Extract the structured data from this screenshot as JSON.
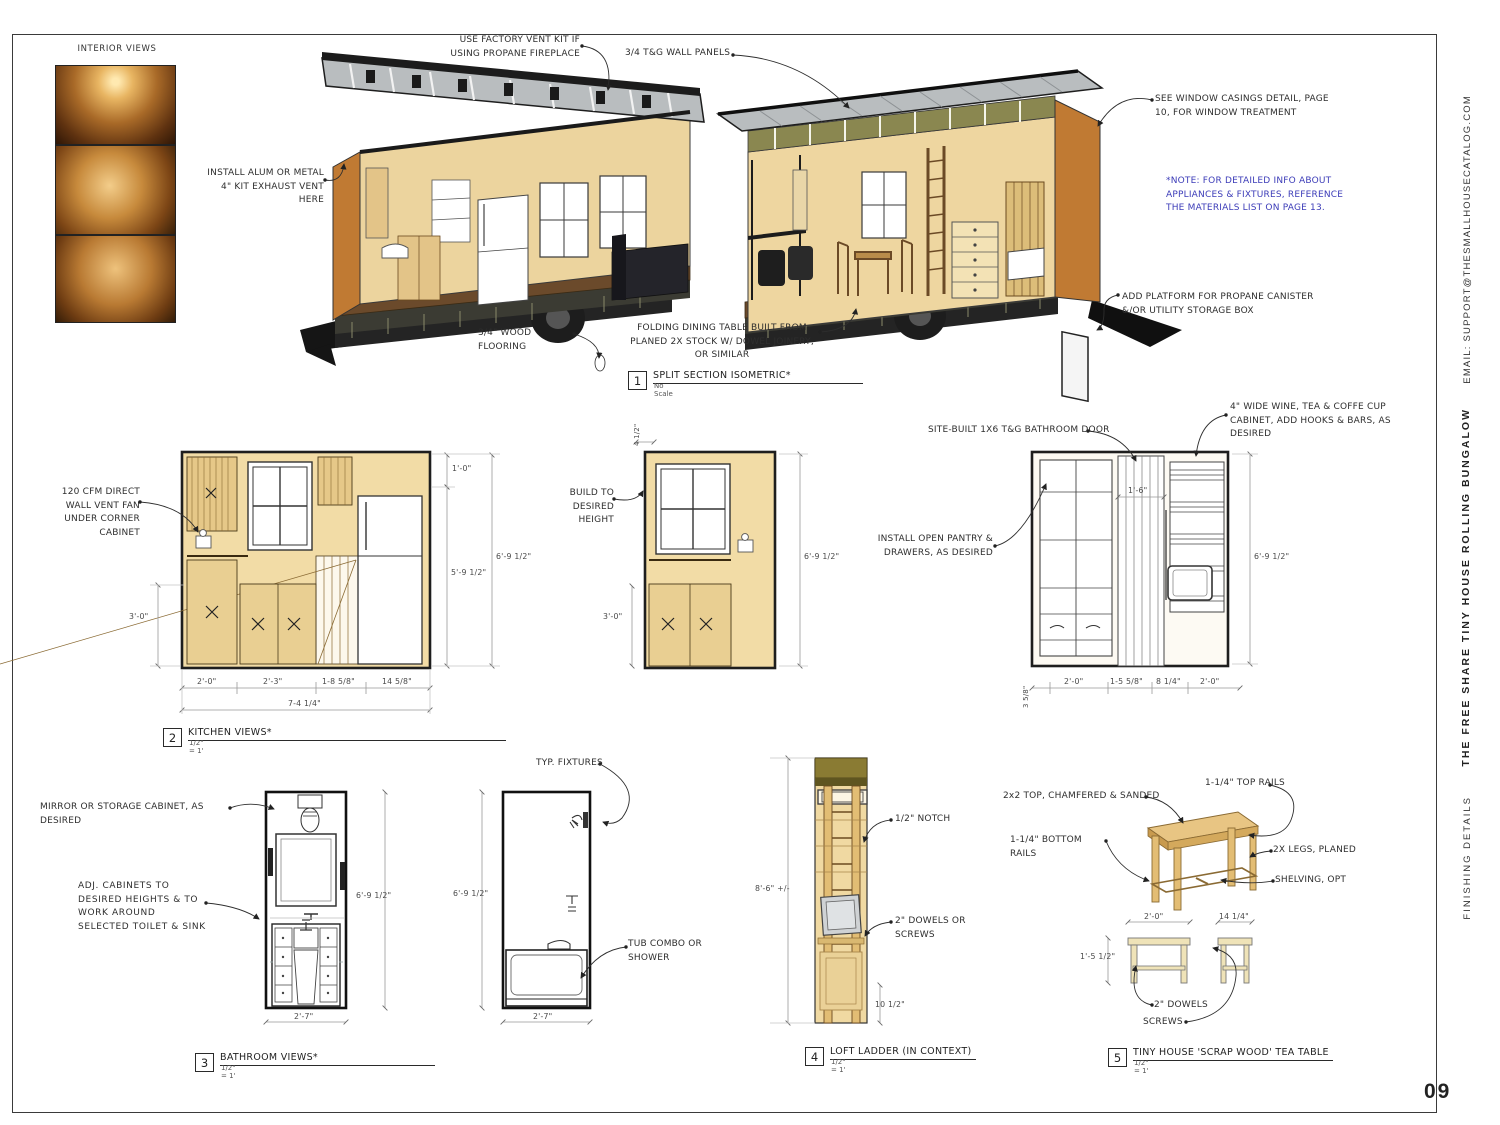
{
  "sheet": {
    "page_number": "09",
    "email_vertical": "EMAIL: SUPPORT@THESMALLHOUSECATALOG.COM",
    "title_vertical": "THE FREE SHARE TINY HOUSE ROLLING BUNGALOW",
    "section_vertical": "FINISHING DETAILS"
  },
  "colors": {
    "paper": "#ffffff",
    "line": "#2b2b2b",
    "wall_tan": "#f2dca6",
    "end_wall_orange": "#c07a33",
    "roof_gray": "#b9bdbf",
    "sheathing_olive": "#8a8750",
    "note_blue": "#3c3cb8",
    "dim_gray": "#999999"
  },
  "interior_views": {
    "label": "INTERIOR VIEWS"
  },
  "iso_notes": {
    "vent_kit": "USE FACTORY VENT KIT IF USING PROPANE FIREPLACE",
    "wall_panels": "3/4 T&G WALL PANELS",
    "exhaust_vent": "INSTALL ALUM OR METAL 4\" KIT EXHAUST VENT HERE",
    "window_casings": "SEE WINDOW CASINGS DETAIL, PAGE 10, FOR WINDOW TREATMENT",
    "materials_note": "*NOTE: FOR DETAILED INFO ABOUT APPLIANCES & FIXTURES, REFERENCE THE MATERIALS LIST ON PAGE 13.",
    "platform": "ADD PLATFORM FOR PROPANE CANISTER &/OR UTILITY STORAGE BOX",
    "flooring": "3/4\" WOOD FLOORING",
    "dining_table": "FOLDING DINING TABLE BUILT FROM PLANED 2X STOCK W/ DOWEL JOINERY, OR SIMILAR"
  },
  "callouts": {
    "c1": {
      "num": "1",
      "title": "SPLIT SECTION ISOMETRIC*",
      "scale": "No Scale"
    },
    "c2": {
      "num": "2",
      "title": "KITCHEN VIEWS*",
      "scale": "1/2\" = 1'"
    },
    "c3": {
      "num": "3",
      "title": "BATHROOM VIEWS*",
      "scale": "1/2\" = 1'"
    },
    "c4": {
      "num": "4",
      "title": "LOFT LADDER (IN CONTEXT)",
      "scale": "1/2\" = 1'"
    },
    "c5": {
      "num": "5",
      "title": "TINY HOUSE 'SCRAP WOOD' TEA TABLE",
      "scale": "1/2\" = 1'"
    }
  },
  "kitchen": {
    "notes": {
      "vent_fan": "120 CFM DIRECT WALL VENT FAN UNDER CORNER CABINET",
      "build_height": "BUILD TO DESIRED HEIGHT",
      "bathroom_door": "SITE-BUILT 1X6 T&G BATHROOM DOOR",
      "wine_cabinet": "4\" WIDE WINE, TEA & COFFE CUP CABINET, ADD HOOKS & BARS, AS DESIRED",
      "pantry": "INSTALL OPEN PANTRY & DRAWERS, AS DESIRED"
    },
    "dims": {
      "a_left": "3'-0\"",
      "a_right_top": "1'-0\"",
      "a_right_mid": "5'-9 1/2\"",
      "a_right_full": "6'-9 1/2\"",
      "a_b1": "2'-0\"",
      "a_b2": "2'-3\"",
      "a_b3": "1-8 5/8\"",
      "a_b4": "14 5/8\"",
      "a_total": "7-4 1/4\"",
      "b_top": "4 1/2\"",
      "b_left": "3'-0\"",
      "b_right": "6'-9 1/2\"",
      "c_inner": "1'-6\"",
      "c_right": "6'-9 1/2\"",
      "c_b0": "3 5/8\"",
      "c_b1": "2'-0\"",
      "c_b2": "1-5 5/8\"",
      "c_b3": "8 1/4\"",
      "c_b4": "2'-0\""
    }
  },
  "bathroom": {
    "notes": {
      "mirror": "MIRROR OR STORAGE CABINET, AS DESIRED",
      "adj_cabinets": "ADJ. CABINETS TO DESIRED HEIGHTS & TO WORK AROUND SELECTED TOILET & SINK",
      "fixtures": "TYP. FIXTURES",
      "tub": "TUB COMBO OR SHOWER"
    },
    "dims": {
      "a_height": "6'-9 1/2\"",
      "b_height": "6'-9 1/2\"",
      "a_width": "2'-7\"",
      "b_width": "2'-7\""
    }
  },
  "ladder": {
    "notes": {
      "notch": "1/2\" NOTCH",
      "dowels": "2\" DOWELS OR SCREWS"
    },
    "dims": {
      "height": "8'-6\" +/-",
      "offset": "10 1/2\""
    }
  },
  "table": {
    "notes": {
      "top": "2x2 TOP, CHAMFERED & SANDED",
      "top_rails": "1-1/4\" TOP RAILS",
      "bottom_rails": "1-1/4\" BOTTOM RAILS",
      "legs": "2X LEGS, PLANED",
      "shelving": "SHELVING, OPT",
      "dowels": "2\" DOWELS",
      "screws": "SCREWS"
    },
    "dims": {
      "width": "2'-0\"",
      "depth": "14 1/4\"",
      "height": "1'-5 1/2\""
    }
  }
}
